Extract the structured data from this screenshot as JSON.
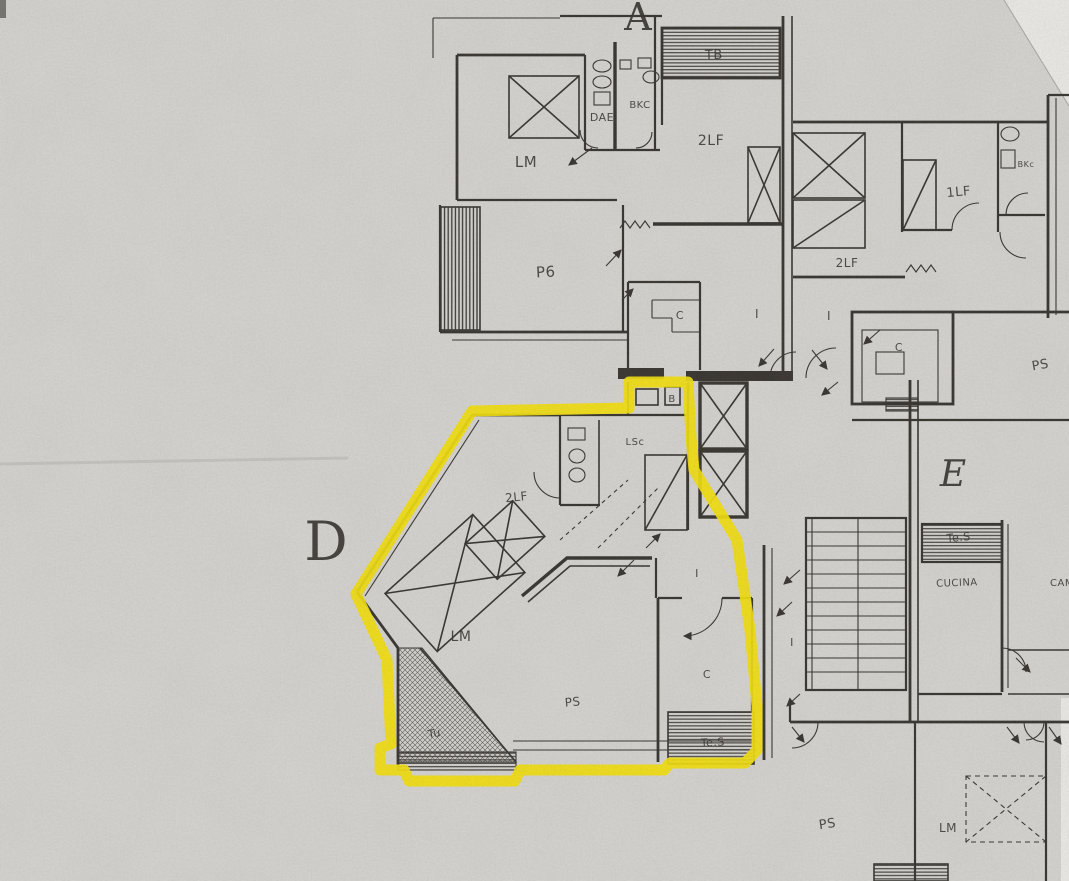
{
  "colors": {
    "paper": "#d8d6d2",
    "paper_edge": "#efede9",
    "ink": "#35322d",
    "highlight": "#f5e20a"
  },
  "highlight": {
    "outlined_unit": "D"
  },
  "labels": {
    "units": [
      {
        "text": "A",
        "x": 638,
        "y": 30,
        "size": 38,
        "italic": false
      },
      {
        "text": "D",
        "x": 326,
        "y": 560,
        "size": 54,
        "italic": false
      },
      {
        "text": "E",
        "x": 953,
        "y": 486,
        "size": 36,
        "italic": true
      }
    ],
    "rooms": [
      {
        "text": "TB",
        "x": 714,
        "y": 59,
        "size": 13,
        "rot": -2
      },
      {
        "text": "DAE",
        "x": 602,
        "y": 121,
        "size": 11,
        "rot": 0
      },
      {
        "text": "BKC",
        "x": 640,
        "y": 108,
        "size": 10,
        "rot": 0
      },
      {
        "text": "LM",
        "x": 526,
        "y": 167,
        "size": 15,
        "rot": 0
      },
      {
        "text": "2LF",
        "x": 711,
        "y": 145,
        "size": 14,
        "rot": 0
      },
      {
        "text": "1LF",
        "x": 959,
        "y": 196,
        "size": 13,
        "rot": -5
      },
      {
        "text": "BKc",
        "x": 1026,
        "y": 167,
        "size": 8,
        "rot": 0
      },
      {
        "text": "2LF",
        "x": 847,
        "y": 267,
        "size": 12,
        "rot": 0
      },
      {
        "text": "P6",
        "x": 546,
        "y": 277,
        "size": 15,
        "rot": -3
      },
      {
        "text": "C",
        "x": 680,
        "y": 319,
        "size": 11,
        "rot": 0
      },
      {
        "text": "I",
        "x": 757,
        "y": 318,
        "size": 12,
        "rot": 0
      },
      {
        "text": "I",
        "x": 829,
        "y": 320,
        "size": 12,
        "rot": 0
      },
      {
        "text": "C",
        "x": 899,
        "y": 351,
        "size": 11,
        "rot": 0
      },
      {
        "text": "PS",
        "x": 1041,
        "y": 369,
        "size": 13,
        "rot": -10
      },
      {
        "text": "2LF",
        "x": 517,
        "y": 501,
        "size": 12,
        "rot": -6
      },
      {
        "text": "B",
        "x": 672,
        "y": 402,
        "size": 10,
        "rot": 0
      },
      {
        "text": "LSc",
        "x": 635,
        "y": 445,
        "size": 10,
        "rot": 0
      },
      {
        "text": "LM",
        "x": 461,
        "y": 641,
        "size": 14,
        "rot": 0
      },
      {
        "text": "PS",
        "x": 573,
        "y": 706,
        "size": 12,
        "rot": -5
      },
      {
        "text": "I",
        "x": 697,
        "y": 577,
        "size": 11,
        "rot": 0
      },
      {
        "text": "C",
        "x": 707,
        "y": 678,
        "size": 11,
        "rot": 0
      },
      {
        "text": "Te.S",
        "x": 713,
        "y": 746,
        "size": 11,
        "rot": -3
      },
      {
        "text": "Tu",
        "x": 435,
        "y": 737,
        "size": 11,
        "rot": -10
      },
      {
        "text": "I",
        "x": 792,
        "y": 646,
        "size": 11,
        "rot": 0
      },
      {
        "text": "Te.S",
        "x": 959,
        "y": 541,
        "size": 11,
        "rot": -5
      },
      {
        "text": "CUCINA",
        "x": 957,
        "y": 586,
        "size": 10,
        "rot": -2
      },
      {
        "text": "CAM",
        "x": 1062,
        "y": 586,
        "size": 10,
        "rot": 0
      },
      {
        "text": "PS",
        "x": 828,
        "y": 828,
        "size": 13,
        "rot": -8
      },
      {
        "text": "LM",
        "x": 948,
        "y": 832,
        "size": 12,
        "rot": 0
      }
    ]
  }
}
